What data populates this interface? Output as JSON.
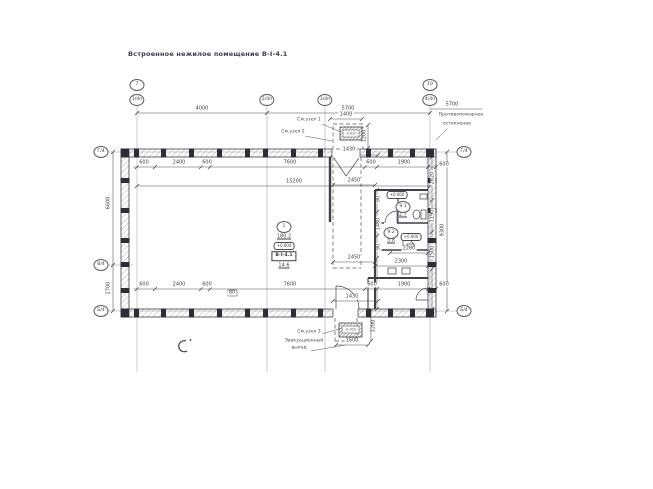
{
  "title": "Встроенное нежилое помещение В-I-4.1",
  "axes": {
    "top_row": [
      "7",
      "10"
    ],
    "sub_row": [
      "1/4п",
      "2/4п",
      "3/4п",
      "4/4п"
    ],
    "left": [
      "Г/4",
      "В/4",
      "Б/4"
    ],
    "right": [
      "Г/4",
      "Б/4"
    ]
  },
  "room_stamp": {
    "number": "1",
    "area": "180.2",
    "elevation": "+0.000",
    "unit": "В-I-4.1",
    "area2": "14.6"
  },
  "rooms": [
    {
      "number": "9.1",
      "area": "2.7",
      "elevation": "+0.000"
    },
    {
      "number": "9.2",
      "area": "3.8",
      "elevation": "+0.000"
    }
  ],
  "annotations": {
    "fire_note_line1": "Противопожарное",
    "fire_note_line2": "остекление",
    "callout_top_1": "См.узел 1",
    "callout_top_2": "См.узел 2",
    "callout_bottom": "См.узел 3",
    "evac_line1": "Эвакуационный",
    "evac_line2": "выход",
    "top_porch_elev": "-0.020",
    "bottom_porch_elev": "-0.020"
  },
  "dims": [
    {
      "t": "4000",
      "x": 202,
      "y": 109
    },
    {
      "t": "5700",
      "x": 348,
      "y": 109
    },
    {
      "t": "5700",
      "x": 452,
      "y": 105
    },
    {
      "t": "1400",
      "x": 346,
      "y": 115
    },
    {
      "t": "1200",
      "x": 365,
      "y": 136,
      "r": 1
    },
    {
      "t": "1430",
      "x": 349,
      "y": 150
    },
    {
      "t": "600",
      "x": 144,
      "y": 163
    },
    {
      "t": "2400",
      "x": 179,
      "y": 163
    },
    {
      "t": "600",
      "x": 207,
      "y": 163
    },
    {
      "t": "7600",
      "x": 290,
      "y": 163
    },
    {
      "t": "600",
      "x": 371,
      "y": 163
    },
    {
      "t": "1900",
      "x": 404,
      "y": 163
    },
    {
      "t": "600",
      "x": 444,
      "y": 165
    },
    {
      "t": "15200",
      "x": 294,
      "y": 182
    },
    {
      "t": "2450",
      "x": 354,
      "y": 181
    },
    {
      "t": "2450",
      "x": 354,
      "y": 258
    },
    {
      "t": "2280",
      "x": 409,
      "y": 249
    },
    {
      "t": "2300",
      "x": 401,
      "y": 262
    },
    {
      "t": "600",
      "x": 144,
      "y": 285
    },
    {
      "t": "2400",
      "x": 179,
      "y": 285
    },
    {
      "t": "600",
      "x": 207,
      "y": 285
    },
    {
      "t": "7600",
      "x": 290,
      "y": 285
    },
    {
      "t": "600",
      "x": 372,
      "y": 285
    },
    {
      "t": "1900",
      "x": 404,
      "y": 285
    },
    {
      "t": "600",
      "x": 444,
      "y": 285
    },
    {
      "t": "1430",
      "x": 352,
      "y": 297
    },
    {
      "t": "80",
      "x": 232,
      "y": 293
    },
    {
      "t": "1600",
      "x": 352,
      "y": 341
    },
    {
      "t": "1200",
      "x": 374,
      "y": 326,
      "r": 1
    },
    {
      "t": "6600",
      "x": 109,
      "y": 203,
      "r": 1
    },
    {
      "t": "2700",
      "x": 109,
      "y": 288,
      "r": 1
    },
    {
      "t": "9300",
      "x": 443,
      "y": 230,
      "r": 1
    },
    {
      "t": "2620",
      "x": 433,
      "y": 178,
      "r": 1
    },
    {
      "t": "1190",
      "x": 433,
      "y": 216,
      "r": 1
    },
    {
      "t": "1500",
      "x": 433,
      "y": 252,
      "r": 1
    },
    {
      "t": "90",
      "x": 379,
      "y": 199,
      "r": 1
    },
    {
      "t": "1480",
      "x": 379,
      "y": 224,
      "r": 1
    },
    {
      "t": "90",
      "x": 379,
      "y": 247,
      "r": 1
    }
  ],
  "colors": {
    "line": "#3f3f46",
    "text": "#3c3c50"
  }
}
